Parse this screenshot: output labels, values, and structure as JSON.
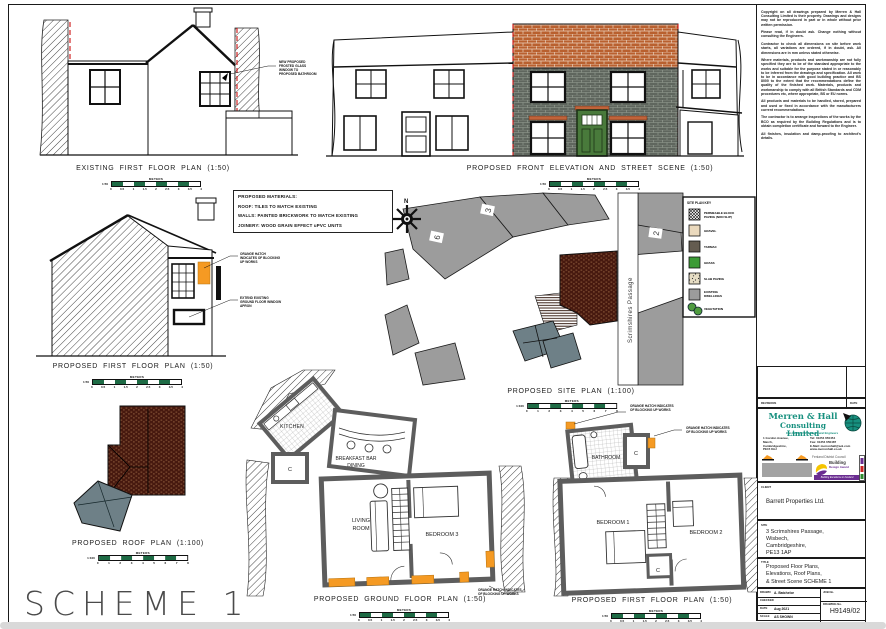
{
  "colors": {
    "accent_orange": "#F59A23",
    "roof_tile": "#B9602F",
    "brick_wall": "#5F665E",
    "door_green": "#497A3B",
    "demolition_red": "#CC1111",
    "scalebar_green": "#1E6B45",
    "site_building_gray": "#9C9C9C",
    "subject_brick": "#47190F",
    "roof_slate_teal": "#6E8087",
    "logo_teal": "#17907F"
  },
  "sheet": {
    "scheme_label": "SCHEME 1",
    "disclaimer": [
      "Copyright on all drawings prepared by Merren & Hall Consulting Limited is their property. Drawings and designs may not be reproduced in part or in whole without prior written permission.",
      "Please read, if in doubt ask. Change nothing without consulting the Engineers.",
      "Contractor to check all dimensions on site before work starts, all variations are ordered, if in doubt, ask. All dimensions are in mm unless stated otherwise.",
      "Where materials, products and workmanship are not fully specified they are to be of the standard appropriate to the works and suitable for the purpose stated in or reasonably to be inferred from the drawings and specification. All work to be in accordance with good building practice and BS 8000 to the extent that the recommendations define the quality of the finished work. Materials, products and workmanship to comply with all British Standards and CDM procedures etc, where appropriate, BS or EU norms.",
      "All products and materials to be handled, stored, prepared and used or fixed in accordance with the manufacturers current recommendations.",
      "The contractor is to arrange inspections of the works by the BCO as required by the Building Regulations and is to obtain completion certificate and forward to the Engineer.",
      "All finishes, insulation and damp-proofing to architect's details."
    ],
    "materials": {
      "title": "PROPOSED MATERIALS:",
      "lines": [
        "ROOF: TILES TO MATCH EXISTING",
        "WALLS: PAINTED BRICKWORK TO MATCH EXISTING",
        "JOINERY: WOOD GRAIN EFFECT uPVC UNITS"
      ]
    },
    "captions": {
      "existing_first_floor": "EXISTING FIRST FLOOR PLAN (1:50)",
      "front_elevation": "PROPOSED FRONT ELEVATION AND STREET SCENE (1:50)",
      "proposed_first_floor_side": "PROPOSED FIRST FLOOR PLAN (1:50)",
      "site_plan": "PROPOSED SITE PLAN (1:100)",
      "roof_plan": "PROPOSED ROOF PLAN (1:100)",
      "ground_floor": "PROPOSED GROUND FLOOR PLAN (1:50)",
      "first_floor": "PROPOSED FIRST FLOOR PLAN (1:50)"
    },
    "annotations": {
      "frosted_window": "NEW PROPOSED FROSTED GLASS WINDOW TO PROPOSED BATHROOM",
      "orange_hatch": "ORANGE HATCH INDICATES OF BLOCKING UP WORKS",
      "extend_window": "EXTEND EXISTING GROUND FLOOR WINDOW APRON"
    },
    "rooms": {
      "kitchen": "KITCHEN",
      "breakfast_bar": "BREAKFAST BAR",
      "dining": "DINING",
      "living_1": "LIVING",
      "living_2": "ROOM",
      "bedroom3": "BEDROOM 3",
      "bathroom": "BATHROOM",
      "bedroom1": "BEDROOM 1",
      "bedroom2": "BEDROOM 2",
      "cupboard": "C"
    },
    "site_plan": {
      "north": "N",
      "street": "Scrimshires Passage",
      "plot_numbers": [
        "6",
        "3",
        "2"
      ],
      "key_title": "SITE PLAN KEY",
      "key_items": [
        {
          "l1": "PERMEABLE BLOCK",
          "l2": "PAVING (NON SLIP)"
        },
        {
          "l1": "GRAVEL",
          "l2": ""
        },
        {
          "l1": "TARMAC",
          "l2": ""
        },
        {
          "l1": "GRASS",
          "l2": ""
        },
        {
          "l1": "SLAB PAVING",
          "l2": ""
        },
        {
          "l1": "EXISTING",
          "l2": "DWELLINGS"
        },
        {
          "l1": "VEGETATION",
          "l2": ""
        }
      ]
    },
    "scalebars": {
      "meters": "METERS",
      "ratio_50": "1:50",
      "ratio_100": "1:100",
      "ticks_50": [
        "0",
        "0.5",
        "1",
        "1.5",
        "2",
        "2.5",
        "3",
        "3.5",
        "4"
      ],
      "ticks_100": [
        "0",
        "1",
        "2",
        "3",
        "4",
        "5",
        "6",
        "7",
        "8"
      ]
    }
  },
  "titleblock": {
    "revisions_label": "REVISIONS",
    "date_label": "DATE",
    "company": {
      "name_line1": "Merren & Hall",
      "name_line2": "Consulting Limited",
      "tagline": "Consulting Civil & Structural Engineers",
      "address": [
        "1 Gordon Avenue,",
        "March,",
        "Cambridgeshire,",
        "PE15 8AJ"
      ],
      "contact": [
        "Tel: 01354 650454",
        "Fax: 01354 650487",
        "E-Mail: merrenhall@aol.com",
        "www.merrenhall.co.uk"
      ]
    },
    "council": "Fenland District Council",
    "award": {
      "line1": "Building",
      "line2": "Design Award",
      "footer": "Building Excellence in Fenland"
    },
    "client": {
      "label": "CLIENT",
      "value": "Barrett Properties Ltd."
    },
    "site": {
      "label": "SITE",
      "lines": [
        "3 Scrimshires Passage,",
        "Wisbech,",
        "Cambridgeshire,",
        "PE13 1AP"
      ]
    },
    "drawing_title": {
      "label": "TITLE",
      "lines": [
        "Proposed Floor Plans,",
        "Elevations, Roof Plans,",
        "& Street Scene SCHEME 1"
      ]
    },
    "fields": {
      "drawn_label": "DRAWN",
      "drawn": "A. Batchelor",
      "checked_label": "CHECKED",
      "checked": "",
      "date_label": "DATE",
      "date": "Aug 2021",
      "scale_label": "SCALE",
      "scale": "AS SHOWN",
      "job_label": "JOB No.",
      "drawing_no_label": "DRAWING No.",
      "drawing_no": "H9149/02"
    }
  }
}
